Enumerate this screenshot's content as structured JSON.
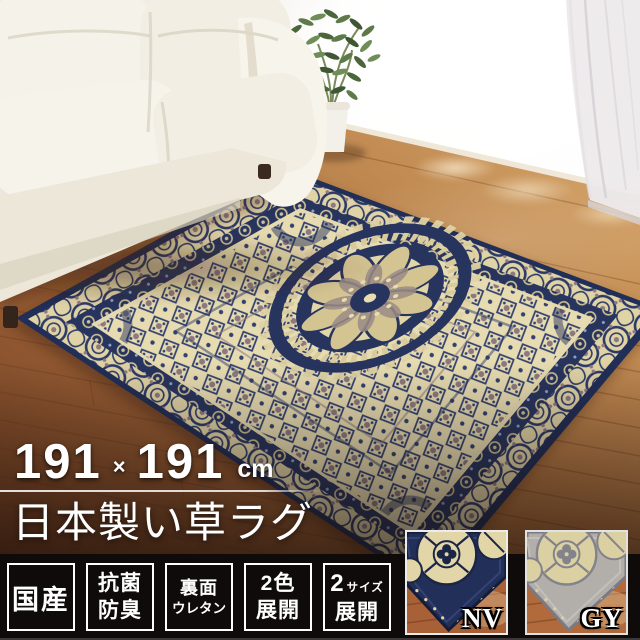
{
  "size_banner": {
    "width_value": "191",
    "multiply_sign": "×",
    "height_value": "191",
    "unit": "cm"
  },
  "product_title": "日本製い草ラグ",
  "feature_badges": [
    {
      "lines": [
        "国産"
      ]
    },
    {
      "lines": [
        "抗菌",
        "防臭"
      ]
    },
    {
      "lines": [
        "裏面",
        "ウレタン"
      ]
    },
    {
      "lines": [
        "2色",
        "展開"
      ]
    },
    {
      "lines": [
        "2",
        "サイズ",
        "展開"
      ]
    }
  ],
  "color_swatches": [
    {
      "label": "NV",
      "rug_color": "#222f58",
      "motif_color": "#e2d5a8"
    },
    {
      "label": "GY",
      "rug_color": "#b2afab",
      "motif_color": "#dbd0a2"
    }
  ],
  "scene": {
    "colors": {
      "rug_navy": "#222f58",
      "rug_cream": "#e3d6a9",
      "rug_taupe": "#8d7a80",
      "floor_wood": "#a4683a",
      "sofa_white": "#f5f2ea",
      "bar_background": "#0f0b0b",
      "overlay_text": "#ffffff"
    }
  }
}
